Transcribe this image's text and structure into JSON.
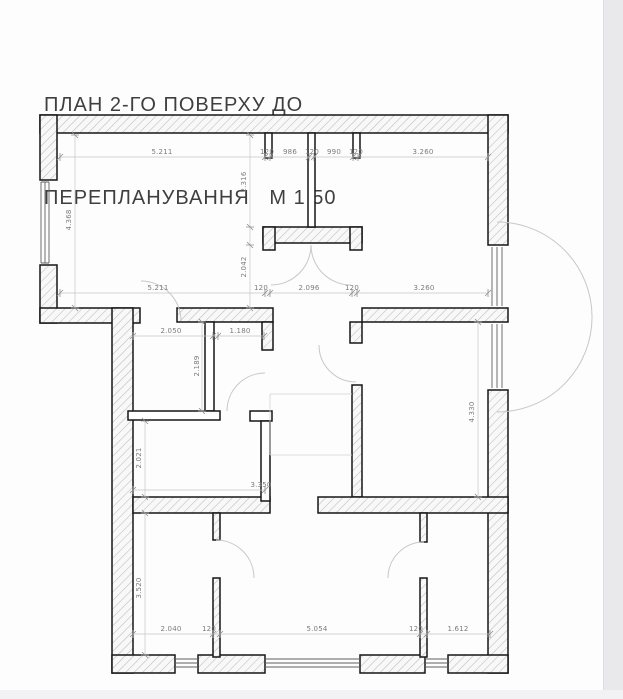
{
  "title": {
    "line1": "ПЛАН 2-ГО ПОВЕРХУ ДО",
    "line2": "ПЕРЕПЛАНУВАННЯ   М 1:50"
  },
  "drawing": {
    "type": "architectural-floor-plan",
    "floor": "2",
    "scale": "1:50",
    "dimension_labels": [
      {
        "value": "5.211",
        "x": 162,
        "y": 154
      },
      {
        "value": "120",
        "x": 267,
        "y": 154
      },
      {
        "value": "986",
        "x": 290,
        "y": 154
      },
      {
        "value": "120",
        "x": 312,
        "y": 154
      },
      {
        "value": "990",
        "x": 334,
        "y": 154
      },
      {
        "value": "120",
        "x": 356,
        "y": 154
      },
      {
        "value": "3.260",
        "x": 423,
        "y": 154
      },
      {
        "value": "2.316",
        "x": 246,
        "y": 182,
        "rot": -90
      },
      {
        "value": "4.368",
        "x": 71,
        "y": 220,
        "rot": -90
      },
      {
        "value": "2.042",
        "x": 246,
        "y": 267,
        "rot": -90
      },
      {
        "value": "5.211",
        "x": 158,
        "y": 290
      },
      {
        "value": "120",
        "x": 261,
        "y": 290
      },
      {
        "value": "2.096",
        "x": 309,
        "y": 290
      },
      {
        "value": "120",
        "x": 352,
        "y": 290
      },
      {
        "value": "3.260",
        "x": 424,
        "y": 290
      },
      {
        "value": "2.050",
        "x": 171,
        "y": 333
      },
      {
        "value": "1.180",
        "x": 240,
        "y": 333
      },
      {
        "value": "2.189",
        "x": 199,
        "y": 366,
        "rot": -90
      },
      {
        "value": "4.330",
        "x": 474,
        "y": 412,
        "rot": -90
      },
      {
        "value": "2.021",
        "x": 141,
        "y": 458,
        "rot": -90
      },
      {
        "value": "3.350",
        "x": 261,
        "y": 487
      },
      {
        "value": "3.520",
        "x": 141,
        "y": 588,
        "rot": -90
      },
      {
        "value": "2.040",
        "x": 171,
        "y": 631
      },
      {
        "value": "120",
        "x": 209,
        "y": 631
      },
      {
        "value": "5.054",
        "x": 317,
        "y": 631
      },
      {
        "value": "120",
        "x": 416,
        "y": 631
      },
      {
        "value": "1.612",
        "x": 458,
        "y": 631
      }
    ]
  },
  "colors": {
    "wall_outline": "#161616",
    "hatch_line": "#bcbcbc",
    "dimension_line": "#c6c6c6",
    "dimension_text": "#7c7c7c",
    "title_text": "#3f3f3f",
    "page_edge": "#e9e9eb"
  }
}
